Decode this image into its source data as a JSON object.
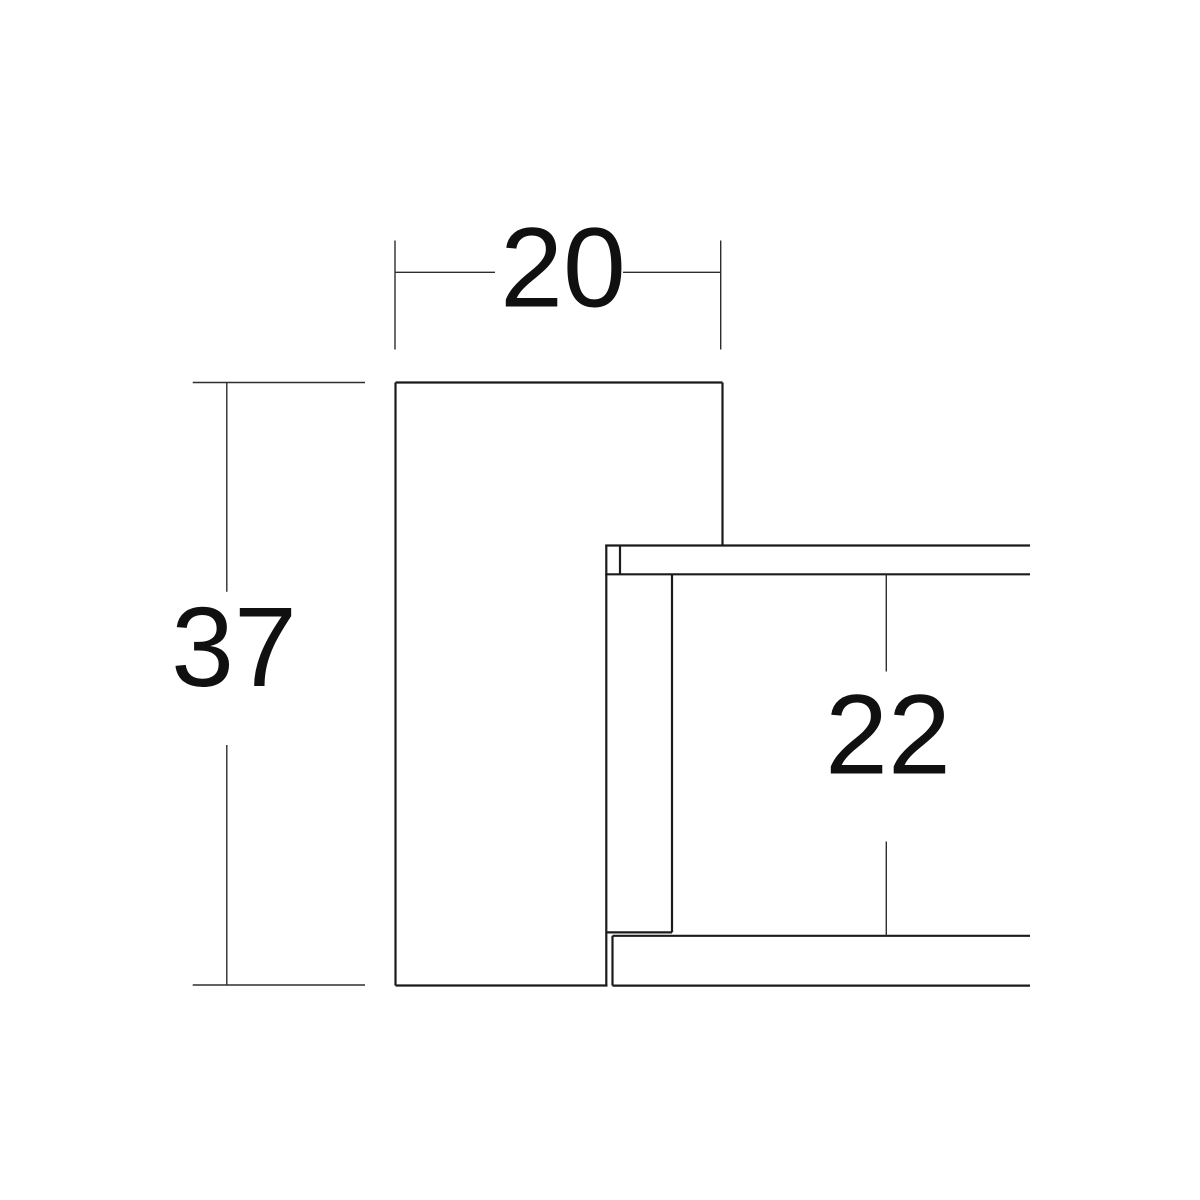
{
  "page": {
    "background": "#ffffff",
    "title": "section-detail-drawing"
  },
  "drawing": {
    "canvas": {
      "width": 1200,
      "height": 1200,
      "background": "#ffffff"
    },
    "styles": {
      "object_line": {
        "color": "#1b1b1b",
        "width": 2.2
      },
      "dimension_line": {
        "color": "#2e2e2e",
        "width": 1.4
      },
      "label": {
        "color": "#101010",
        "font_size": 113
      }
    },
    "object_lines": [
      {
        "name": "panel-top-edge",
        "x1": 395.5,
        "y1": 382.5,
        "x2": 722.5,
        "y2": 382.5
      },
      {
        "name": "panel-left-edge",
        "x1": 395.5,
        "y1": 382.5,
        "x2": 395.5,
        "y2": 985.5
      },
      {
        "name": "panel-right-upper-edge",
        "x1": 722.5,
        "y1": 382.5,
        "x2": 722.5,
        "y2": 546.0
      },
      {
        "name": "panel-bottom-edge",
        "x1": 395.5,
        "y1": 985.5,
        "x2": 607.5,
        "y2": 985.5
      },
      {
        "name": "panel-inner-right-edge",
        "x1": 606.3,
        "y1": 545.5,
        "x2": 606.3,
        "y2": 985.6
      },
      {
        "name": "top-strip-top-edge",
        "x1": 605.2,
        "y1": 545.5,
        "x2": 1030.0,
        "y2": 545.5
      },
      {
        "name": "top-strip-bottom-edge",
        "x1": 605.2,
        "y1": 574.3,
        "x2": 1030.0,
        "y2": 574.3
      },
      {
        "name": "top-strip-end-cap",
        "x1": 620.0,
        "y1": 545.5,
        "x2": 620.0,
        "y2": 574.3
      },
      {
        "name": "under-panel-right-edge",
        "x1": 672.0,
        "y1": 574.3,
        "x2": 672.0,
        "y2": 932.4
      },
      {
        "name": "under-panel-bottom-edge",
        "x1": 606.3,
        "y1": 932.4,
        "x2": 672.0,
        "y2": 932.4
      },
      {
        "name": "bottom-strip-top-edge",
        "x1": 612.5,
        "y1": 935.8,
        "x2": 1030.0,
        "y2": 935.8
      },
      {
        "name": "bottom-strip-left-cap",
        "x1": 612.5,
        "y1": 935.8,
        "x2": 612.5,
        "y2": 985.6
      },
      {
        "name": "bottom-strip-bottom-edge",
        "x1": 612.5,
        "y1": 985.6,
        "x2": 1030.0,
        "y2": 985.6
      }
    ],
    "dimension_lines": [
      {
        "name": "dim-20-extension-left",
        "x1": 395.0,
        "y1": 240.5,
        "x2": 395.0,
        "y2": 349.5
      },
      {
        "name": "dim-20-extension-right",
        "x1": 720.7,
        "y1": 240.5,
        "x2": 720.7,
        "y2": 349.5
      },
      {
        "name": "dim-20-line-left",
        "x1": 395.0,
        "y1": 272.3,
        "x2": 495.0,
        "y2": 272.3
      },
      {
        "name": "dim-20-line-right",
        "x1": 623.0,
        "y1": 272.3,
        "x2": 720.7,
        "y2": 272.3
      },
      {
        "name": "dim-37-extension-top",
        "x1": 192.7,
        "y1": 382.5,
        "x2": 365.0,
        "y2": 382.5
      },
      {
        "name": "dim-37-extension-bottom",
        "x1": 192.7,
        "y1": 985.0,
        "x2": 365.0,
        "y2": 985.0
      },
      {
        "name": "dim-37-line-upper",
        "x1": 226.8,
        "y1": 382.5,
        "x2": 226.8,
        "y2": 591.7
      },
      {
        "name": "dim-37-line-lower",
        "x1": 226.8,
        "y1": 745.0,
        "x2": 226.8,
        "y2": 985.0
      },
      {
        "name": "dim-22-line-upper",
        "x1": 886.3,
        "y1": 574.3,
        "x2": 886.3,
        "y2": 671.5
      },
      {
        "name": "dim-22-line-lower",
        "x1": 886.3,
        "y1": 841.5,
        "x2": 886.3,
        "y2": 935.8
      }
    ],
    "labels": [
      {
        "name": "dim-label-20",
        "text": "20",
        "x": 563,
        "y": 306.5
      },
      {
        "name": "dim-label-37",
        "text": "37",
        "x": 234,
        "y": 686.0
      },
      {
        "name": "dim-label-22",
        "text": "22",
        "x": 888,
        "y": 773.3
      }
    ]
  }
}
